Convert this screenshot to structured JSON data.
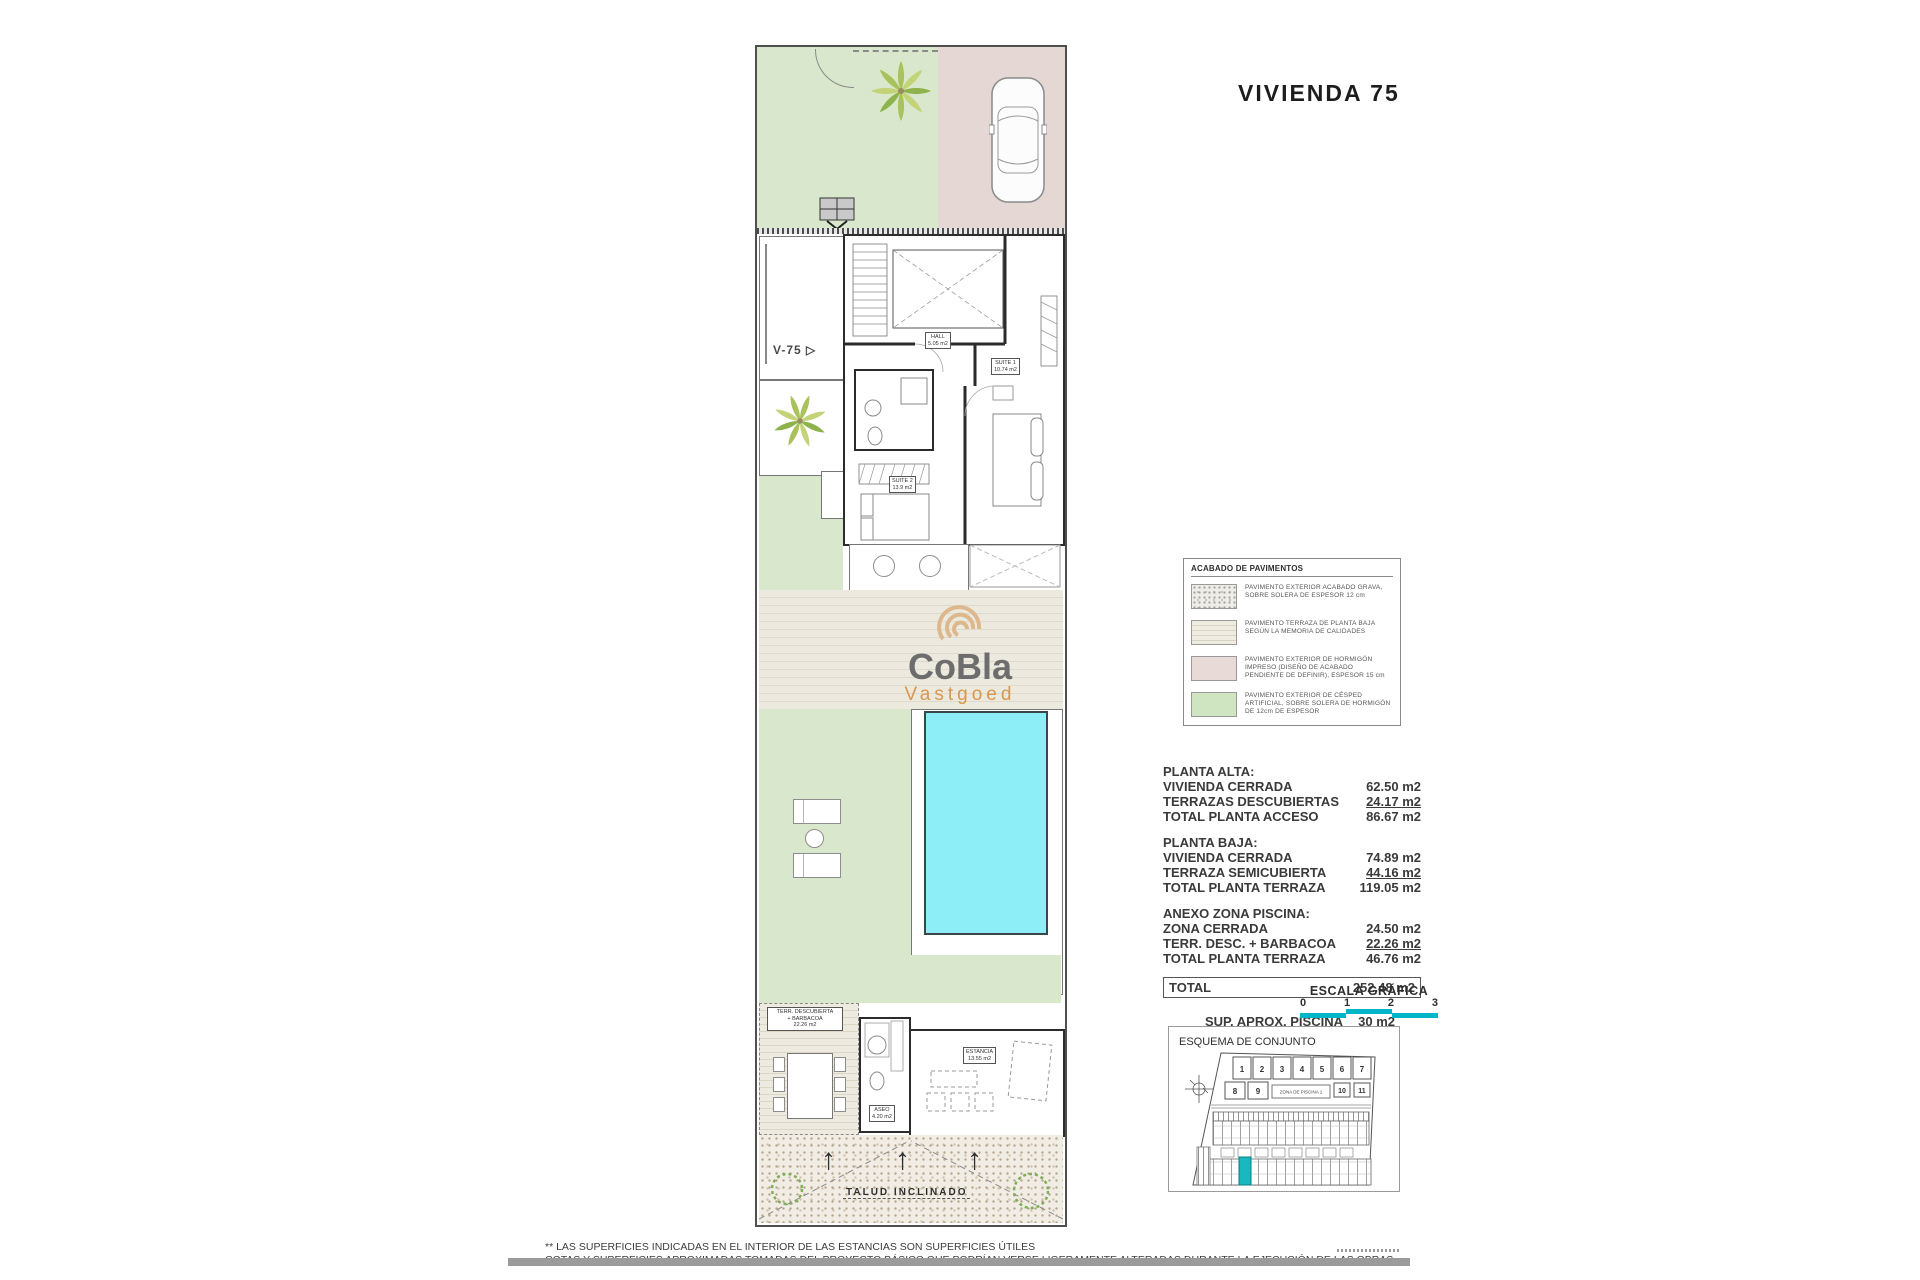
{
  "page": {
    "title": "VIVIENDA 75"
  },
  "watermark": {
    "name": "CoBla",
    "sub": "Vastgoed"
  },
  "plan": {
    "v75": "V-75",
    "talud": "TALUD INCLINADO",
    "rooms": {
      "hall": {
        "name": "HALL",
        "area": "5.05 m2"
      },
      "suite1": {
        "name": "SUITE 1",
        "area": "10.74 m2"
      },
      "suite2": {
        "name": "SUITE 2",
        "area": "13.9 m2"
      },
      "aseo": {
        "name": "ASEO",
        "area": "4.20 m2"
      },
      "estancia": {
        "name": "ESTANCIA",
        "area": "13.55 m2"
      }
    },
    "terr_label": {
      "l1": "TERR. DESCUBIERTA",
      "l2": "+ BARBACOA",
      "l3": "22.26 m2"
    }
  },
  "legend": {
    "title": "ACABADO DE PAVIMENTOS",
    "items": [
      {
        "swatch": "grava-pattern",
        "text": "PAVIMENTO EXTERIOR ACABADO GRAVA, SOBRE SOLERA DE ESPESOR 12 cm"
      },
      {
        "swatch": "terraza-stripes",
        "text": "PAVIMENTO TERRAZA DE PLANTA BAJA SEGÚN LA MEMORIA DE CALIDADES"
      },
      {
        "swatch": "hormigon-pink",
        "text": "PAVIMENTO EXTERIOR DE HORMIGÓN IMPRESO (DISEÑO DE ACABADO PENDIENTE DE DEFINIR), ESPESOR 15 cm"
      },
      {
        "swatch": "cesped-green",
        "text": "PAVIMENTO EXTERIOR DE CÉSPED ARTIFICIAL, SOBRE SOLERA DE HORMIGÓN DE 12cm DE ESPESOR"
      }
    ]
  },
  "areas": {
    "groups": [
      {
        "title": "PLANTA ALTA:",
        "rows": [
          {
            "label": "VIVIENDA CERRADA",
            "value": "62.50 m2"
          },
          {
            "label": "TERRAZAS DESCUBIERTAS",
            "value": "24.17 m2"
          },
          {
            "label": "TOTAL PLANTA ACCESO",
            "value": "86.67 m2"
          }
        ]
      },
      {
        "title": "PLANTA BAJA:",
        "rows": [
          {
            "label": "VIVIENDA CERRADA",
            "value": "74.89 m2"
          },
          {
            "label": "TERRAZA SEMICUBIERTA",
            "value": "44.16 m2"
          },
          {
            "label": "TOTAL PLANTA TERRAZA",
            "value": "119.05 m2"
          }
        ]
      },
      {
        "title": "ANEXO ZONA PISCINA:",
        "rows": [
          {
            "label": "ZONA CERRADA",
            "value": "24.50 m2"
          },
          {
            "label": "TERR. DESC. + BARBACOA",
            "value": "22.26 m2"
          },
          {
            "label": "TOTAL PLANTA TERRAZA",
            "value": "46.76 m2"
          }
        ]
      }
    ],
    "total": {
      "label": "TOTAL",
      "value": "252.48 m2"
    },
    "extras": [
      {
        "label": "SUP.  APROX. PISCINA",
        "value": "30 m2"
      },
      {
        "label": "SUP.  APROX. PARCELA",
        "value": "400 m2"
      }
    ]
  },
  "scale": {
    "title": "ESCALA GRÁFICA",
    "ticks": [
      "0",
      "1",
      "2",
      "3"
    ]
  },
  "esquema": {
    "title": "ESQUEMA DE CONJUNTO",
    "zone": "ZONA DE PISCINA 1",
    "plots_top": [
      "1",
      "2",
      "3",
      "4",
      "5",
      "6",
      "7"
    ],
    "plots_left": [
      "8",
      "9"
    ],
    "plots_right": [
      "10",
      "11"
    ]
  },
  "footer": {
    "line1": "** LAS SUPERFICIES INDICADAS EN EL INTERIOR DE LAS ESTANCIAS SON SUPERFICIES ÚTILES",
    "line2": "COTAS Y SUPERFICIES APROXIMADAS TOMADAS DEL PROYECTO BÁSICO QUE PODRÍAN VERSE LIGERAMENTE ALTERADAS DURANTE LA EJECUCIÓN DE LAS OBRAS"
  },
  "colors": {
    "accent_teal": "#00b5c8",
    "pool": "#8deef7",
    "lawn": "#d9e8cc",
    "driveway": "#e5d7d3",
    "logo_orange": "#d9974e",
    "logo_gray": "#6d6d6d"
  }
}
